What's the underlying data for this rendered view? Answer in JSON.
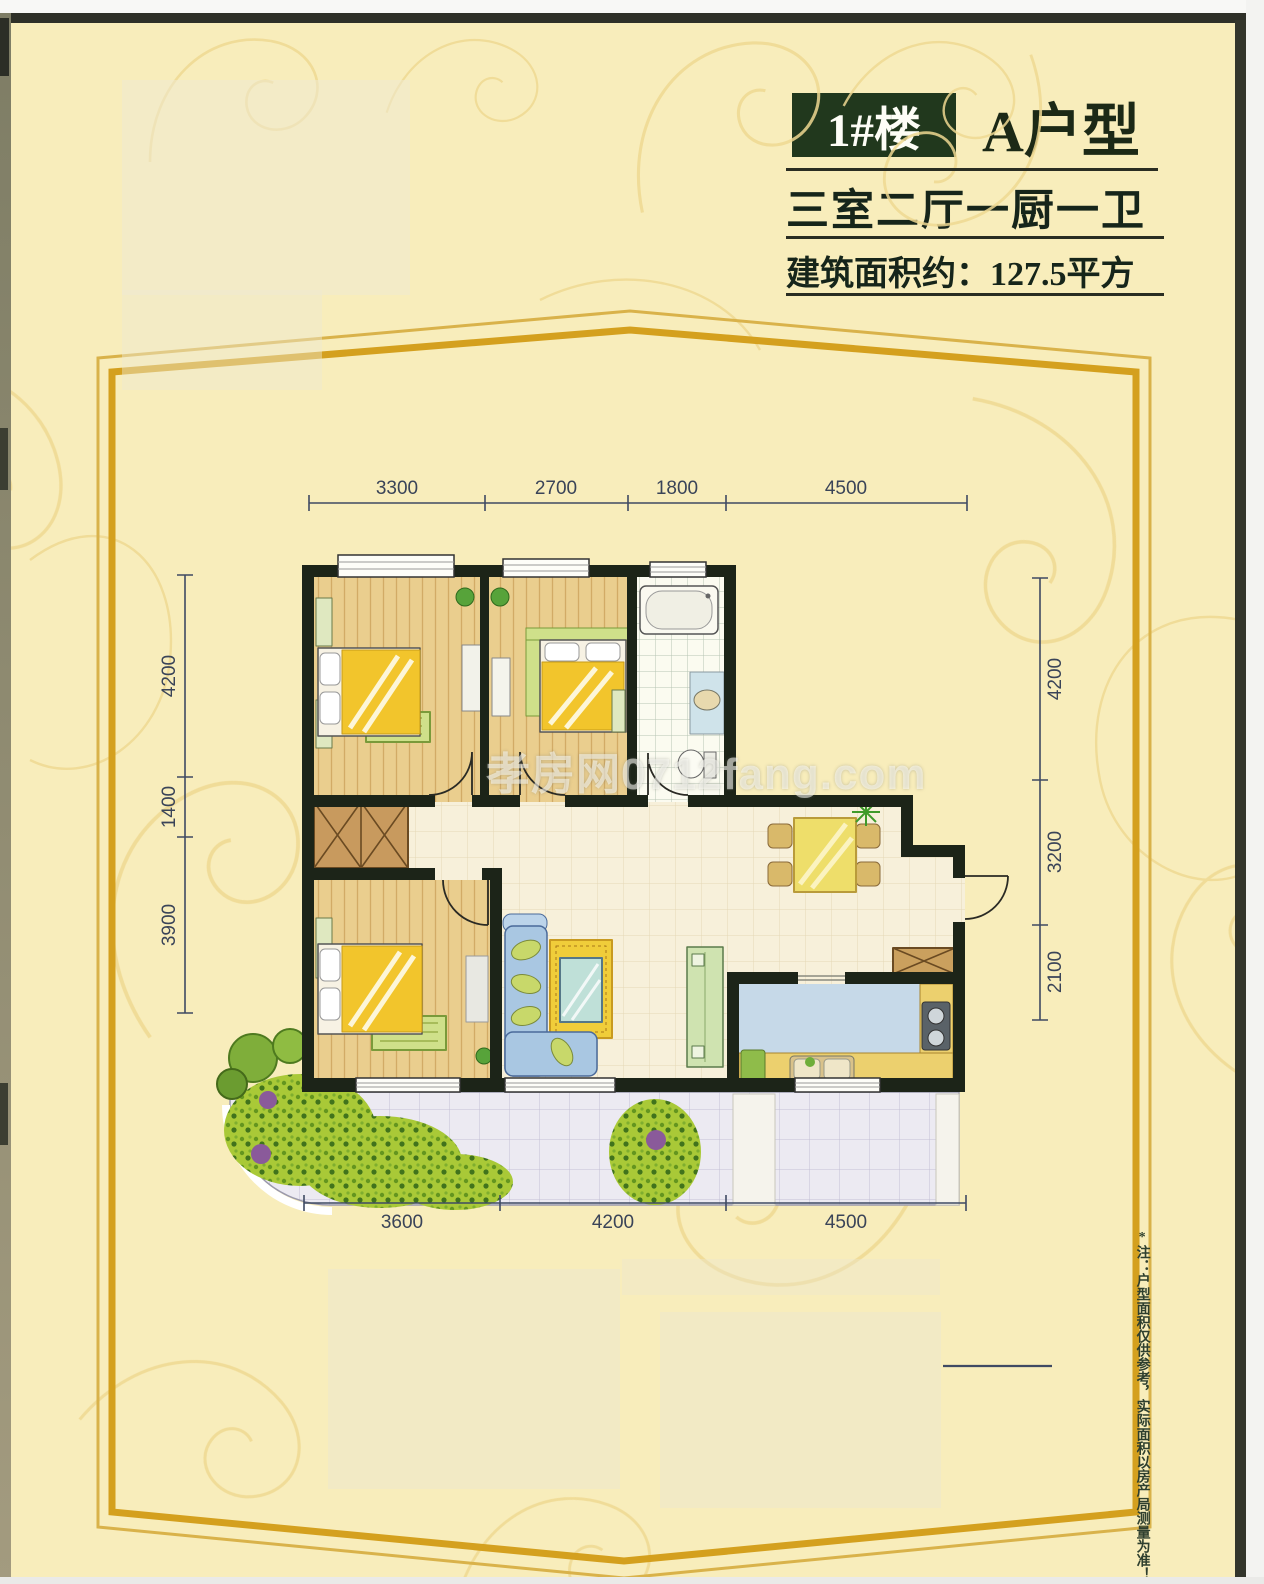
{
  "header": {
    "building_badge": "1#楼",
    "unit_type": "A户型",
    "layout": "三室二厅一厨一卫",
    "area": "建筑面积约：127.5平方"
  },
  "floor_plan": {
    "dimensions_top": [
      "3300",
      "2700",
      "1800",
      "4500"
    ],
    "dimensions_bottom": [
      "3600",
      "4200",
      "4500"
    ],
    "dimensions_left": [
      "4200",
      "1400",
      "3900"
    ],
    "dimensions_right": [
      "4200",
      "3200",
      "2100"
    ]
  },
  "watermark": "孝房网0712fang.com",
  "footnote": "*注：户型面积仅供参考，实际面积以房产局测量为准！",
  "colors": {
    "page_background": "#f8edbb",
    "pattern_gold": "#efd992",
    "frame_gold": "#d4a01e",
    "frame_gold_light": "#d9b24a",
    "badge_green": "#21381d",
    "wall_dark": "#1c2418",
    "dimension_line": "#3f4a63"
  }
}
